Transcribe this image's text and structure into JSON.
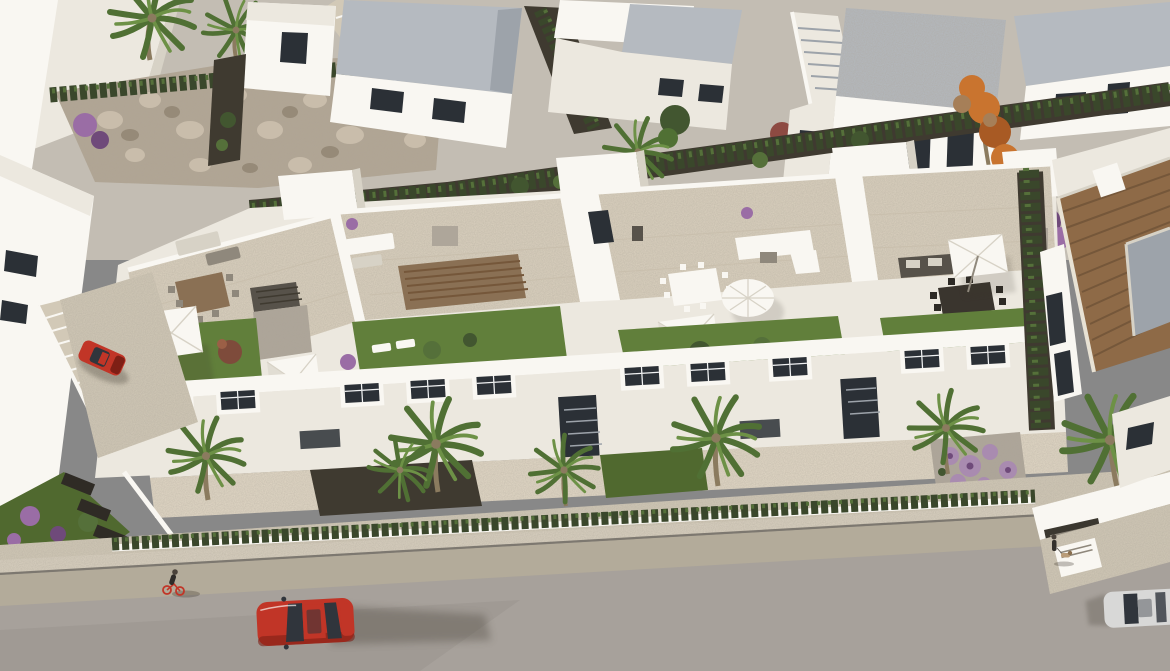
{
  "scene": {
    "type": "aerial-architectural-render",
    "description": "Aerial 3D render of a white Mediterranean townhouse complex with rooftop terraces, lawns and parasols, surrounded by gardens, palm trees, a terracotta-roof villa, background rows of white houses with cypress hedges, and a street with cars in the foreground",
    "time_of_day": "late-afternoon-sunlight-from-left",
    "main_complex": {
      "units": 4,
      "rooftop_lawns": 4,
      "parasols": [
        {
          "name": "square-umbrella-left",
          "color": "white"
        },
        {
          "name": "shade-sail-left-corner",
          "color": "white"
        },
        {
          "name": "round-umbrella-center",
          "color": "white"
        },
        {
          "name": "shade-sail-center",
          "color": "white"
        },
        {
          "name": "tilted-umbrella-right",
          "color": "white"
        }
      ],
      "furniture": [
        "wood-dining-table",
        "white-dining-table",
        "black-dining-table",
        "white-corner-sofa",
        "black-corner-sofa",
        "sun-loungers",
        "louvered-pergolas"
      ],
      "facade_windows": 12,
      "stairwell_towers": 4
    },
    "right_villa": {
      "roof": "terracotta-tiles",
      "flat_inset_roof": "gray",
      "garden": "purple-allium-balls-on-gravel",
      "palm_trees": 1
    },
    "left_building": {
      "parked_car_color": "red",
      "exterior_staircase": true
    },
    "background": {
      "white_houses": 7,
      "gray_flat_roofs": true,
      "cypress_hedges": true,
      "stone_rubble_wall": true,
      "curved_step_path": true,
      "autumn_orange_tree": 1,
      "purple_bougainvillea": 2,
      "palm_trees": 3
    },
    "street": {
      "road_color_hex": "#a7a19b",
      "sidewalk_color_hex": "#d9d0c0",
      "vehicles": [
        {
          "name": "red-car-driving",
          "color_hex": "#c13527"
        },
        {
          "name": "silver-car-partial-right-edge",
          "color_hex": "#d8d8d7"
        },
        {
          "name": "red-car-parked-left",
          "color_hex": "#c13527"
        }
      ],
      "people": [
        {
          "name": "cyclist-with-red-bike"
        },
        {
          "name": "dog-walker"
        }
      ],
      "dogs": 1,
      "front_hedge": true
    },
    "counts": {
      "parasols": 5,
      "cars": 3,
      "people": 2,
      "dogs": 1,
      "rooftop_lawns": 4,
      "palm_trees_foreground": 6
    }
  },
  "palette": {
    "base": "#c7bfb1",
    "upper": "#c3bdb3",
    "road": "#a7a19b",
    "roadTan": "#b3ab9a",
    "sidewalk": "#d9d0c0",
    "pavement": "#d2c9b7",
    "patio": "#e2d8c6",
    "curb": "#7d7870",
    "whiteLit": "#f9f7f2",
    "whiteMid": "#ece8df",
    "whiteShade": "#d7d2c6",
    "whiteDeep": "#bfb9ac",
    "roofGray": "#b5bac0",
    "roofGrayDark": "#9da3aa",
    "windowDark": "#2b3036",
    "frame": "#f0f1f2",
    "lawn": "#617f3b",
    "lawnShade": "#50692f",
    "lawnBright": "#6f8f45",
    "hedge": "#3a472b",
    "hedgeLight": "#55703a",
    "conifer": "#425630",
    "palm": "#507034",
    "palmLight": "#6d9146",
    "trunk": "#8b7b5f",
    "terrace": "#dbd1bf",
    "terraceShade": "#c9bfad",
    "gravel": "#aea69a",
    "gravelDark": "#8f887c",
    "pergola": "#57524a",
    "woodBrown": "#8a7054",
    "stone": "#b2a694",
    "stoneLight": "#c9bdab",
    "stoneDark": "#968a78",
    "orange": "#c9742f",
    "orangeDark": "#a85a24",
    "purple": "#9a6da5",
    "purpleDark": "#6f4a7a",
    "purpleBall": "#a98bb0",
    "redCar": "#c13527",
    "redCarDark": "#7e1f15",
    "carWindow": "#30353c",
    "silver": "#d8d8d7",
    "silverDark": "#9fa2a4",
    "shadow": "#3a352b",
    "darkBed": "#3f3a30",
    "terracotta": "#8e6a47",
    "terracottaDark": "#75573a",
    "terracottaLight": "#a67f58"
  }
}
